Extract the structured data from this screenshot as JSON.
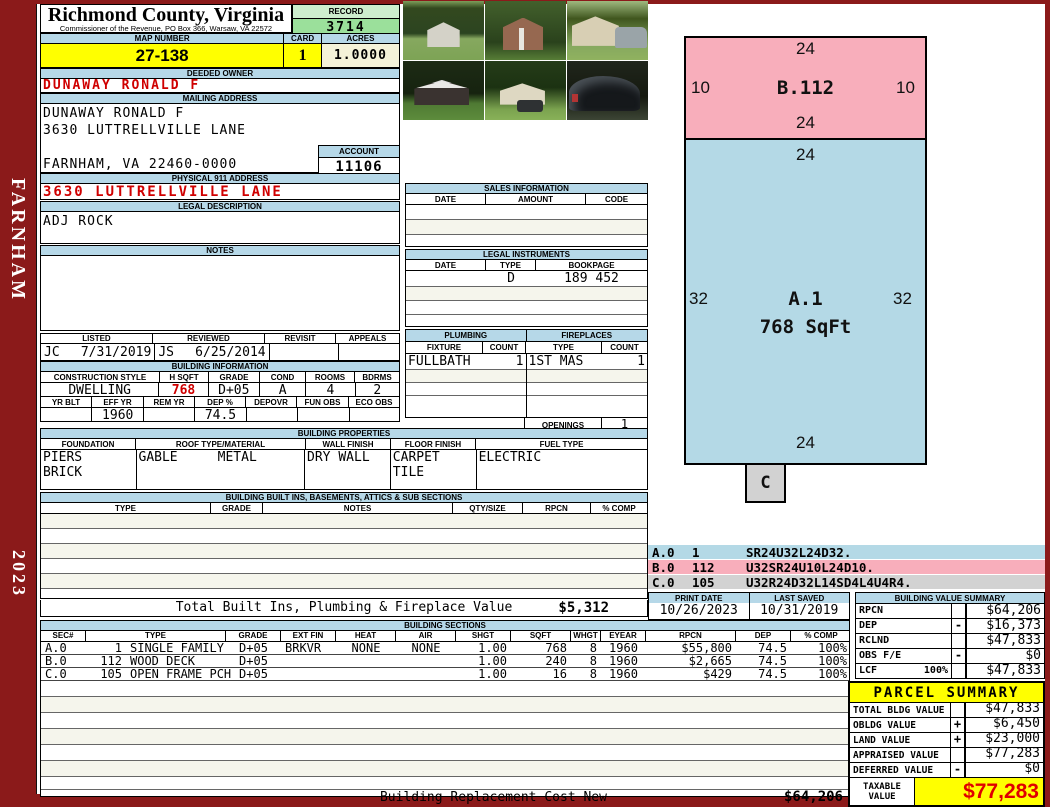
{
  "sidebar": {
    "district": "FARNHAM",
    "year": "2023"
  },
  "header": {
    "county_title": "Richmond County, Virginia",
    "county_subtitle": "Commissioner of the Revenue, PO Box 366, Warsaw, VA 22572",
    "record_label": "RECORD",
    "record_value": "3714",
    "map_label": "MAP NUMBER",
    "map_value": "27-138",
    "card_label": "CARD",
    "card_value": "1",
    "acres_label": "ACRES",
    "acres_value": "1.0000"
  },
  "owner": {
    "deeded_label": "DEEDED OWNER",
    "deeded_value": "DUNAWAY RONALD F",
    "mailing_label": "MAILING ADDRESS",
    "mailing_lines": [
      "DUNAWAY RONALD F",
      "3630 LUTTRELLVILLE LANE",
      "",
      "FARNHAM, VA 22460-0000"
    ],
    "account_label": "ACCOUNT",
    "account_value": "11106",
    "physical_label": "PHYSICAL 911 ADDRESS",
    "physical_value": "3630 LUTTRELLVILLE LANE",
    "legal_label": "LEGAL DESCRIPTION",
    "legal_value": "ADJ ROCK",
    "notes_label": "NOTES"
  },
  "review": {
    "headers": [
      "LISTED",
      "REVIEWED",
      "REVISIT",
      "APPEALS"
    ],
    "listed_initials": "JC",
    "listed_date": "7/31/2019",
    "reviewed_initials": "JS",
    "reviewed_date": "6/25/2014",
    "revisit": "",
    "appeals": ""
  },
  "building_info": {
    "title": "BUILDING INFORMATION",
    "row1_headers": [
      "CONSTRUCTION STYLE",
      "H SQFT",
      "GRADE",
      "COND",
      "ROOMS",
      "BDRMS"
    ],
    "row1_values": [
      "DWELLING",
      "768",
      "D+05",
      "A",
      "4",
      "2"
    ],
    "row2_headers": [
      "YR BLT",
      "EFF YR",
      "REM YR",
      "DEP %",
      "DEPOVR",
      "FUN OBS",
      "ECO OBS"
    ],
    "row2_values": [
      "",
      "1960",
      "",
      "74.5",
      "",
      "",
      ""
    ]
  },
  "sales": {
    "title": "SALES INFORMATION",
    "headers": [
      "DATE",
      "AMOUNT",
      "CODE"
    ]
  },
  "instruments": {
    "title": "LEGAL INSTRUMENTS",
    "headers": [
      "DATE",
      "TYPE",
      "BOOKPAGE"
    ],
    "row1": {
      "date": "",
      "type": "D",
      "bookpage": "189 452"
    }
  },
  "plumbing": {
    "title": "PLUMBING",
    "headers": [
      "FIXTURE",
      "COUNT"
    ],
    "row1": {
      "fixture": "FULLBATH",
      "count": "1"
    }
  },
  "fireplaces": {
    "title": "FIREPLACES",
    "headers": [
      "TYPE",
      "COUNT"
    ],
    "row1": {
      "type": "1ST MAS",
      "count": "1"
    },
    "openings_label": "OPENINGS",
    "openings_value": "1"
  },
  "properties": {
    "title": "BUILDING PROPERTIES",
    "headers": [
      "FOUNDATION",
      "ROOF TYPE/MATERIAL",
      "WALL FINISH",
      "FLOOR FINISH",
      "FUEL TYPE"
    ],
    "foundation1": "PIERS",
    "foundation2": "BRICK",
    "roof_type": "GABLE",
    "roof_material": "METAL",
    "wall_finish": "DRY WALL",
    "floor_finish1": "CARPET",
    "floor_finish2": "TILE",
    "fuel_type": "ELECTRIC"
  },
  "builtins": {
    "title": "BUILDING BUILT INS, BASEMENTS, ATTICS & SUB SECTIONS",
    "headers": [
      "TYPE",
      "GRADE",
      "NOTES",
      "QTY/SIZE",
      "RPCN",
      "% COMP"
    ],
    "total_label": "Total Built Ins, Plumbing & Fireplace Value",
    "total_value": "$5,312"
  },
  "sections": {
    "title": "BUILDING SECTIONS",
    "headers": [
      "SEC#",
      "TYPE",
      "GRADE",
      "EXT FIN",
      "HEAT",
      "AIR",
      "SHGT",
      "SQFT",
      "WHGT",
      "EYEAR",
      "RPCN",
      "DEP",
      "% COMP"
    ],
    "rows": [
      {
        "sec": "A.0",
        "code": "1",
        "type": "SINGLE FAMILY",
        "grade": "D+05",
        "extfin": "BRKVR",
        "heat": "NONE",
        "air": "NONE",
        "shgt": "1.00",
        "sqft": "768",
        "whgt": "8",
        "eyear": "1960",
        "rpcn": "$55,800",
        "dep": "74.5",
        "comp": "100%"
      },
      {
        "sec": "B.0",
        "code": "112",
        "type": "WOOD DECK",
        "grade": "D+05",
        "extfin": "",
        "heat": "",
        "air": "",
        "shgt": "1.00",
        "sqft": "240",
        "whgt": "8",
        "eyear": "1960",
        "rpcn": "$2,665",
        "dep": "74.5",
        "comp": "100%"
      },
      {
        "sec": "C.0",
        "code": "105",
        "type": "OPEN FRAME PCH",
        "grade": "D+05",
        "extfin": "",
        "heat": "",
        "air": "",
        "shgt": "1.00",
        "sqft": "16",
        "whgt": "8",
        "eyear": "1960",
        "rpcn": "$429",
        "dep": "74.5",
        "comp": "100%"
      }
    ],
    "footer_label": "Building Replacement Cost New",
    "footer_value": "$64,206"
  },
  "sketch": {
    "b": {
      "label": "B.112",
      "top": "24",
      "left": "10",
      "right": "10",
      "bottom": "24"
    },
    "a": {
      "label": "A.1",
      "sqft": "768 SqFt",
      "top": "24",
      "left": "32",
      "right": "32",
      "bottom": "24"
    },
    "c": {
      "label": "C"
    },
    "segments": [
      {
        "sec": "A.0",
        "code": "1",
        "path": "SR24U32L24D32."
      },
      {
        "sec": "B.0",
        "code": "112",
        "path": "U32SR24U10L24D10."
      },
      {
        "sec": "C.0",
        "code": "105",
        "path": "U32R24D32L14SD4L4U4R4."
      }
    ]
  },
  "meta": {
    "print_label": "PRINT DATE",
    "print_value": "10/26/2023",
    "saved_label": "LAST SAVED",
    "saved_value": "10/31/2019"
  },
  "value_summary": {
    "title": "BUILDING VALUE SUMMARY",
    "rows": [
      {
        "label": "RPCN",
        "pct": "",
        "op": "",
        "value": "$64,206"
      },
      {
        "label": "DEP",
        "pct": "",
        "op": "-",
        "value": "$16,373"
      },
      {
        "label": "RCLND",
        "pct": "",
        "op": "",
        "value": "$47,833"
      },
      {
        "label": "OBS F/E",
        "pct": "",
        "op": "-",
        "value": "$0"
      },
      {
        "label": "LCF",
        "pct": "100%",
        "op": "",
        "value": "$47,833"
      }
    ]
  },
  "parcel_summary": {
    "title": "PARCEL SUMMARY",
    "rows": [
      {
        "label": "TOTAL BLDG VALUE",
        "op": "",
        "value": "$47,833"
      },
      {
        "label": "OBLDG VALUE",
        "op": "+",
        "value": "$6,450"
      },
      {
        "label": "LAND VALUE",
        "op": "+",
        "value": "$23,000"
      },
      {
        "label": "APPRAISED VALUE",
        "op": "",
        "value": "$77,283"
      },
      {
        "label": "DEFERRED VALUE",
        "op": "-",
        "value": "$0"
      }
    ],
    "taxable_label_1": "TAXABLE",
    "taxable_label_2": "VALUE",
    "taxable_value": "$77,283"
  },
  "colors": {
    "frame_maroon": "#8b1a1a",
    "header_blue": "#b6d8e8",
    "highlight_yellow": "#ffff00",
    "record_green": "#9be09b",
    "sketch_pink": "#f8aebb",
    "sketch_blue": "#b4d9e6",
    "sketch_gray": "#d2d2d2",
    "alert_red": "#cf0000",
    "acres_ivory": "#f4f2d8"
  }
}
